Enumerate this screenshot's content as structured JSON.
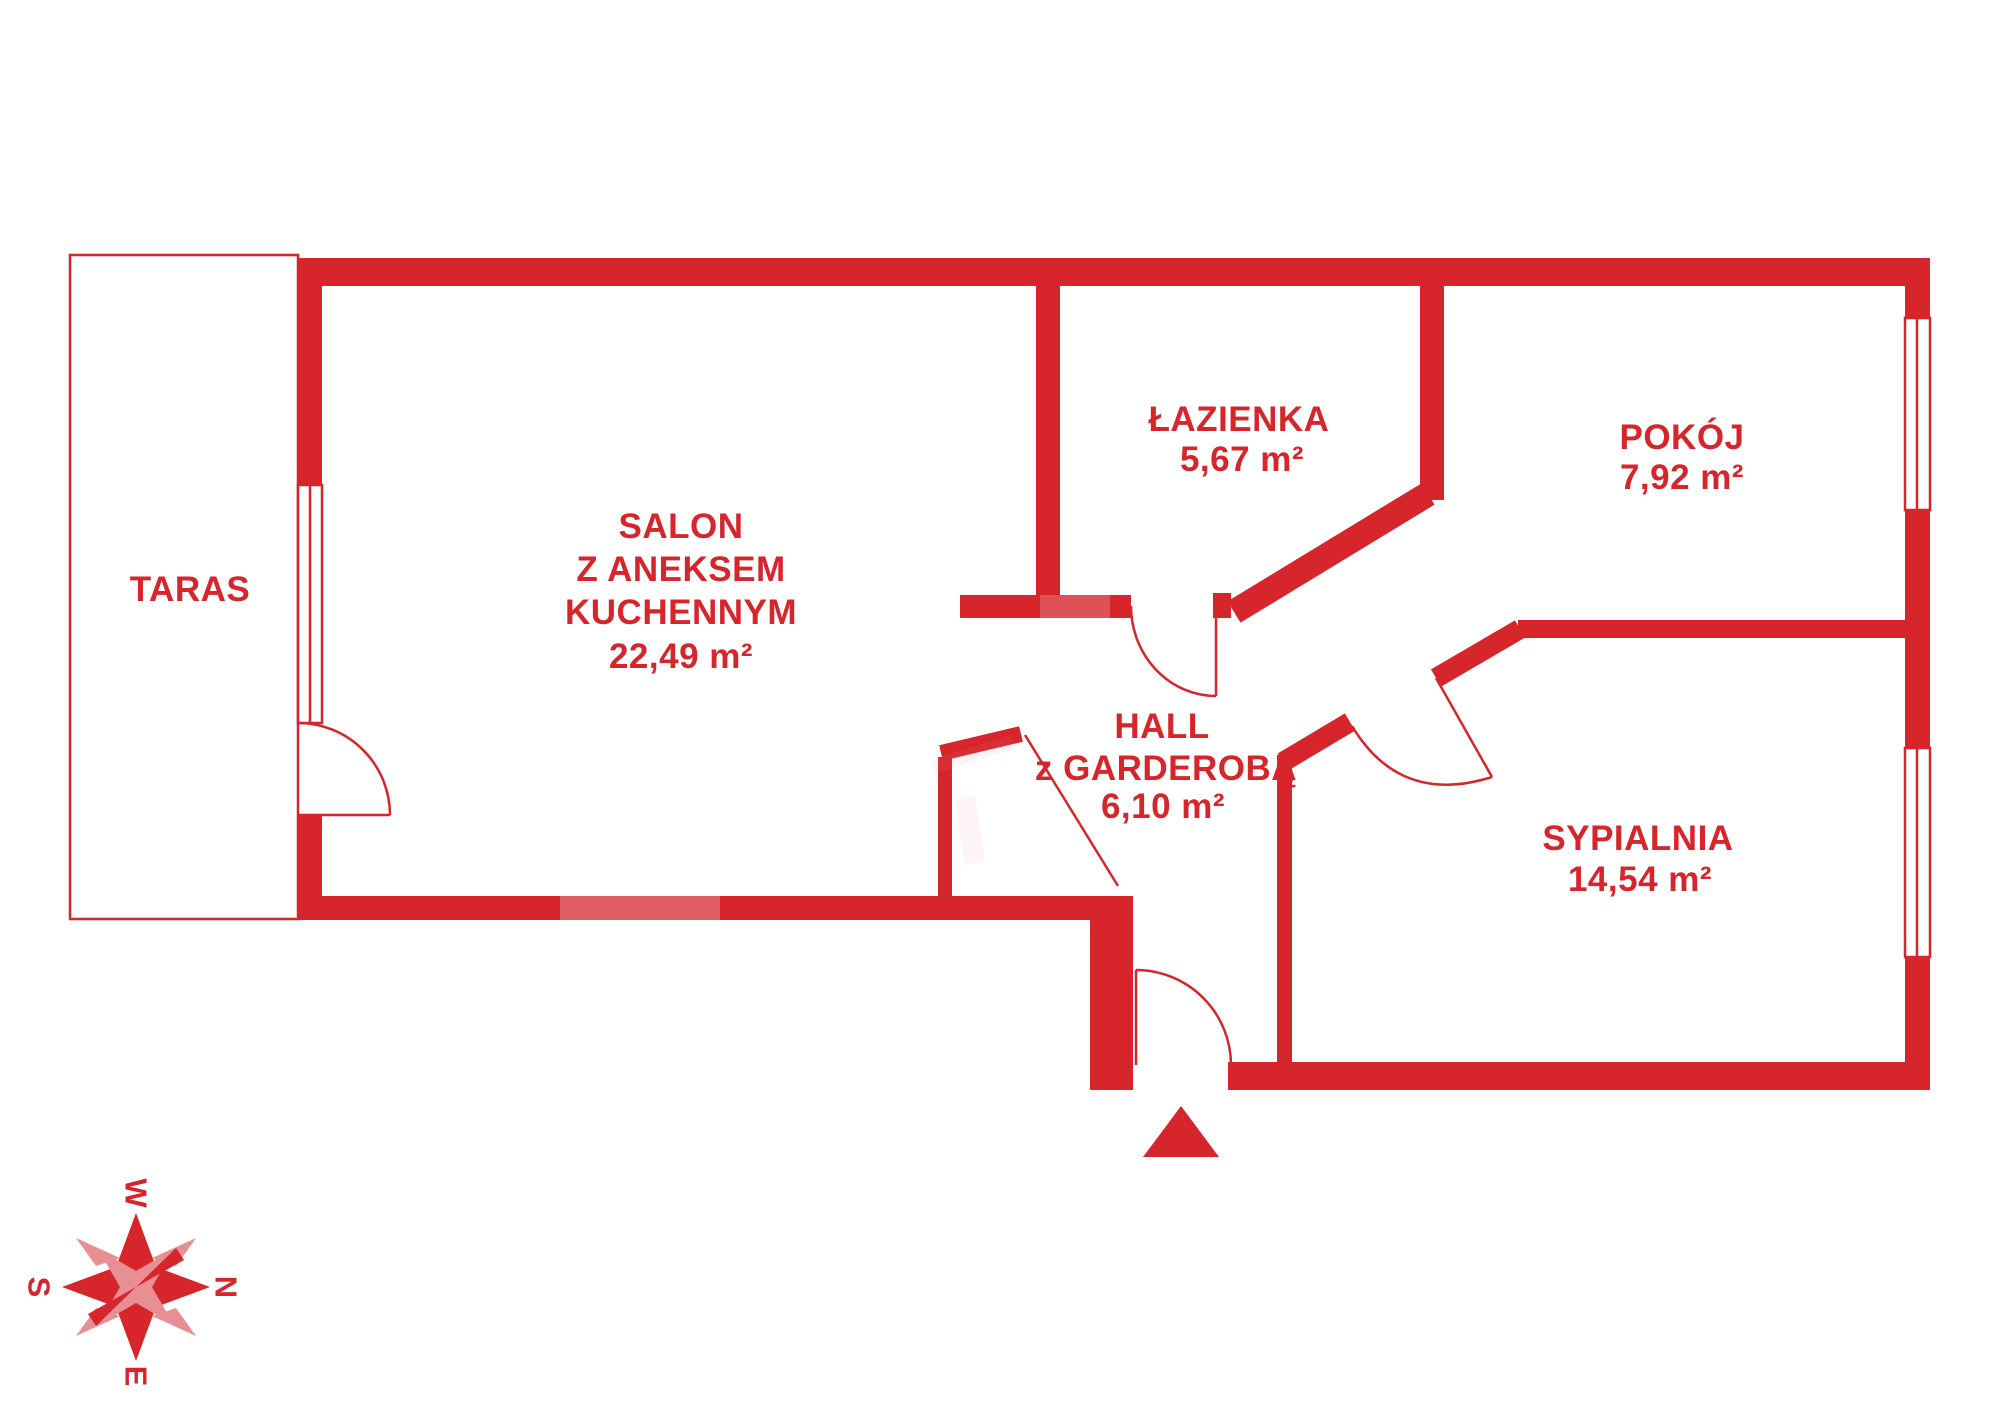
{
  "colors": {
    "wall_red": "#d6252b",
    "compass_light_red": "#e88f93",
    "background": "#ffffff"
  },
  "rooms": {
    "taras": {
      "line1": "TARAS"
    },
    "salon": {
      "line1": "SALON",
      "line2": "Z ANEKSEM",
      "line3": "KUCHENNYM",
      "area": "22,49 m²"
    },
    "lazienka": {
      "line1": "ŁAZIENKA",
      "area": "5,67 m²"
    },
    "pokoj": {
      "line1": "POKÓJ",
      "area": "7,92 m²"
    },
    "hall": {
      "line1": "HALL",
      "line2": "z GARDEROBĄ",
      "area": "6,10 m²"
    },
    "sypialnia": {
      "line1": "SYPIALNIA",
      "area": "14,54 m²"
    }
  },
  "compass": {
    "w": "W",
    "n": "N",
    "s": "S",
    "e": "E"
  }
}
